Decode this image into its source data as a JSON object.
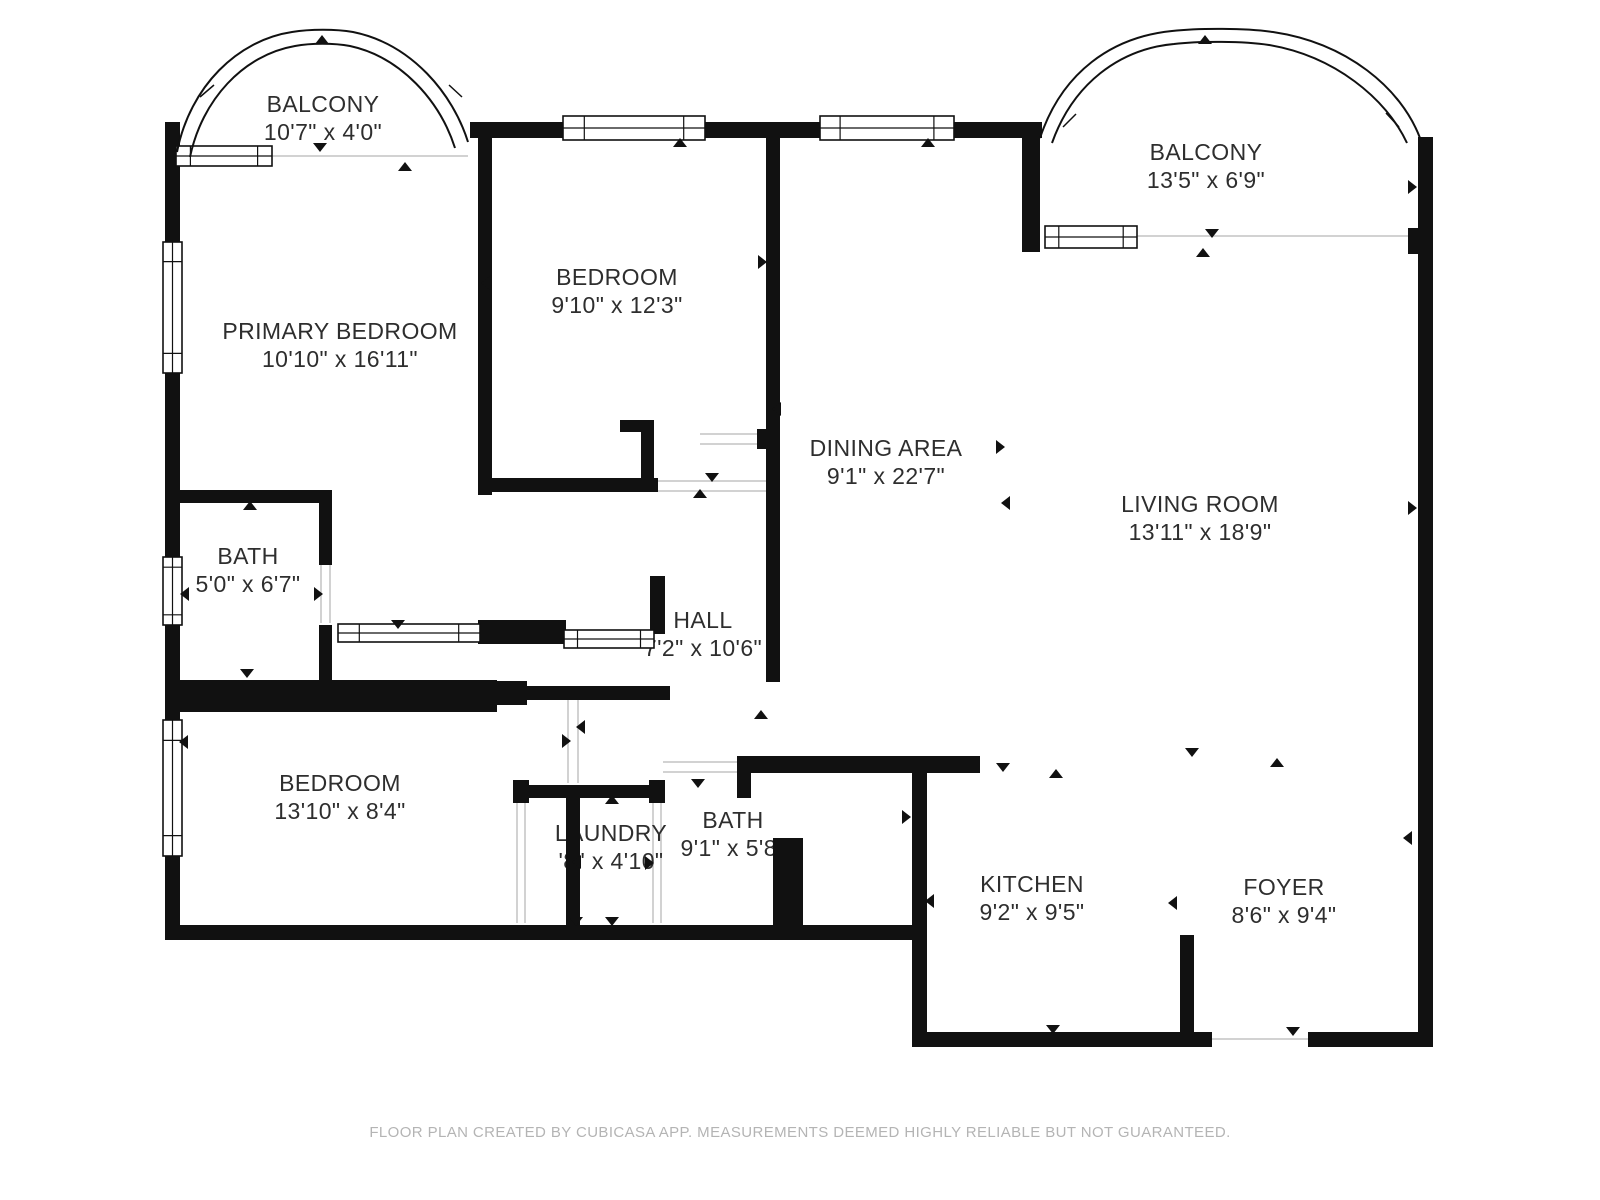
{
  "page": {
    "width": 1600,
    "height": 1200,
    "bg": "#ffffff"
  },
  "footer": {
    "text": "FLOOR PLAN CREATED BY CUBICASA APP. MEASUREMENTS DEEMED HIGHLY RELIABLE BUT NOT GUARANTEED."
  },
  "colors": {
    "wall": "#111111",
    "door_line": "#d2d2d2",
    "text": "#2e2e2e",
    "footer": "#b4b4b4",
    "bg": "#ffffff"
  },
  "rooms": [
    {
      "id": "balcony-top-left",
      "name": "BALCONY",
      "dims": "10'7\" x 4'0\"",
      "x": 323,
      "y": 104
    },
    {
      "id": "balcony-top-right",
      "name": "BALCONY",
      "dims": "13'5\" x 6'9\"",
      "x": 1206,
      "y": 152
    },
    {
      "id": "primary-bedroom",
      "name": "PRIMARY BEDROOM",
      "dims": "10'10\" x 16'11\"",
      "x": 340,
      "y": 331
    },
    {
      "id": "bedroom-top",
      "name": "BEDROOM",
      "dims": "9'10\" x 12'3\"",
      "x": 617,
      "y": 277
    },
    {
      "id": "dining-area",
      "name": "DINING AREA",
      "dims": "9'1\" x 22'7\"",
      "x": 886,
      "y": 448
    },
    {
      "id": "living-room",
      "name": "LIVING ROOM",
      "dims": "13'11\" x 18'9\"",
      "x": 1200,
      "y": 504
    },
    {
      "id": "bath-primary",
      "name": "BATH",
      "dims": "5'0\" x 6'7\"",
      "x": 248,
      "y": 556
    },
    {
      "id": "hall",
      "name": "HALL",
      "dims": "7'2\" x 10'6\"",
      "x": 703,
      "y": 620
    },
    {
      "id": "bedroom-bottom",
      "name": "BEDROOM",
      "dims": "13'10\" x 8'4\"",
      "x": 340,
      "y": 783
    },
    {
      "id": "laundry",
      "name": "LAUNDRY",
      "dims": "'8\" x 4'10\"",
      "x": 611,
      "y": 833
    },
    {
      "id": "bath-main",
      "name": "BATH",
      "dims": "9'1\" x 5'8\"",
      "x": 733,
      "y": 820
    },
    {
      "id": "kitchen",
      "name": "KITCHEN",
      "dims": "9'2\" x 9'5\"",
      "x": 1032,
      "y": 884
    },
    {
      "id": "foyer",
      "name": "FOYER",
      "dims": "8'6\" x 9'4\"",
      "x": 1284,
      "y": 887
    }
  ],
  "plan": {
    "walls": [
      [
        165,
        122,
        15,
        120
      ],
      [
        165,
        373,
        15,
        184
      ],
      [
        165,
        625,
        15,
        95
      ],
      [
        165,
        856,
        15,
        84
      ],
      [
        165,
        925,
        762,
        15
      ],
      [
        912,
        760,
        15,
        287
      ],
      [
        912,
        1032,
        300,
        15
      ],
      [
        1308,
        1032,
        125,
        15
      ],
      [
        1418,
        137,
        15,
        910
      ],
      [
        470,
        122,
        572,
        16
      ],
      [
        1022,
        122,
        18,
        130
      ],
      [
        478,
        138,
        14,
        357
      ],
      [
        766,
        122,
        14,
        560
      ],
      [
        478,
        478,
        180,
        14
      ],
      [
        620,
        420,
        34,
        12
      ],
      [
        641,
        432,
        13,
        50
      ],
      [
        757,
        429,
        9,
        20
      ],
      [
        165,
        490,
        167,
        13
      ],
      [
        319,
        490,
        13,
        75
      ],
      [
        319,
        625,
        13,
        67
      ],
      [
        165,
        680,
        332,
        32
      ],
      [
        497,
        681,
        30,
        24
      ],
      [
        497,
        686,
        173,
        14
      ],
      [
        478,
        620,
        88,
        24
      ],
      [
        650,
        576,
        15,
        58
      ],
      [
        513,
        780,
        16,
        23
      ],
      [
        649,
        780,
        16,
        23
      ],
      [
        513,
        785,
        152,
        13
      ],
      [
        566,
        798,
        14,
        127
      ],
      [
        737,
        756,
        243,
        17
      ],
      [
        737,
        756,
        14,
        42
      ],
      [
        773,
        838,
        30,
        89
      ],
      [
        1180,
        935,
        14,
        99
      ],
      [
        1408,
        228,
        10,
        26
      ]
    ],
    "windows": [
      {
        "x": 163,
        "y": 242,
        "w": 19,
        "h": 131,
        "o": "v"
      },
      {
        "x": 163,
        "y": 557,
        "w": 19,
        "h": 68,
        "o": "v"
      },
      {
        "x": 163,
        "y": 720,
        "w": 19,
        "h": 136,
        "o": "v"
      },
      {
        "x": 176,
        "y": 146,
        "w": 96,
        "h": 20,
        "o": "h"
      },
      {
        "x": 563,
        "y": 116,
        "w": 142,
        "h": 24,
        "o": "h"
      },
      {
        "x": 820,
        "y": 116,
        "w": 134,
        "h": 24,
        "o": "h"
      },
      {
        "x": 1045,
        "y": 226,
        "w": 92,
        "h": 22,
        "o": "h"
      },
      {
        "x": 338,
        "y": 624,
        "w": 142,
        "h": 18,
        "o": "h"
      },
      {
        "x": 564,
        "y": 630,
        "w": 90,
        "h": 18,
        "o": "h"
      }
    ],
    "door_lines": [
      [
        272,
        156,
        468,
        156
      ],
      [
        1137,
        236,
        1416,
        236
      ],
      [
        658,
        481,
        766,
        481
      ],
      [
        658,
        491,
        766,
        491
      ],
      [
        700,
        434,
        757,
        434
      ],
      [
        700,
        444,
        757,
        444
      ],
      [
        321,
        565,
        321,
        623
      ],
      [
        330,
        565,
        330,
        623
      ],
      [
        568,
        700,
        568,
        783
      ],
      [
        578,
        700,
        578,
        783
      ],
      [
        517,
        798,
        517,
        923
      ],
      [
        525,
        798,
        525,
        923
      ],
      [
        653,
        798,
        653,
        923
      ],
      [
        661,
        798,
        661,
        923
      ],
      [
        663,
        762,
        737,
        762
      ],
      [
        663,
        772,
        737,
        772
      ],
      [
        1212,
        1039,
        1308,
        1039
      ]
    ],
    "arches": [
      {
        "id": "balcony-arch-left",
        "outer": "M 177 152 C 190 86 238 40 292 32 C 310 29 336 29 353 32 C 412 44 453 94 468 142",
        "inner": "M 190 157 C 202 100 243 55 295 46 C 311 43 334 43 350 46 C 401 57 440 101 455 148",
        "ticks": [
          [
            200,
            97,
            214,
            85
          ],
          [
            462,
            97,
            449,
            85
          ]
        ]
      },
      {
        "id": "balcony-arch-right",
        "outer": "M 1040 138 C 1062 72 1112 37 1172 31 C 1199 28 1246 28 1273 32 C 1347 43 1401 88 1420 138",
        "inner": "M 1052 143 C 1073 84 1119 49 1174 44 C 1199 41 1244 41 1269 45 C 1334 56 1386 98 1407 143",
        "ticks": [
          [
            1063,
            127,
            1076,
            114
          ],
          [
            1399,
            127,
            1386,
            113
          ]
        ]
      }
    ],
    "arrows": [
      [
        322,
        40,
        "up"
      ],
      [
        320,
        147,
        "down"
      ],
      [
        405,
        167,
        "up"
      ],
      [
        680,
        143,
        "up"
      ],
      [
        928,
        143,
        "up"
      ],
      [
        1205,
        40,
        "up"
      ],
      [
        1212,
        233,
        "down"
      ],
      [
        1203,
        253,
        "up"
      ],
      [
        1412,
        187,
        "right"
      ],
      [
        1412,
        508,
        "right"
      ],
      [
        1408,
        838,
        "left"
      ],
      [
        486,
        283,
        "left"
      ],
      [
        762,
        262,
        "right"
      ],
      [
        777,
        409,
        "left"
      ],
      [
        712,
        477,
        "down"
      ],
      [
        700,
        494,
        "up"
      ],
      [
        250,
        506,
        "up"
      ],
      [
        185,
        594,
        "left"
      ],
      [
        318,
        594,
        "right"
      ],
      [
        247,
        673,
        "down"
      ],
      [
        398,
        624,
        "down"
      ],
      [
        566,
        741,
        "right"
      ],
      [
        581,
        727,
        "left"
      ],
      [
        698,
        783,
        "down"
      ],
      [
        761,
        715,
        "up"
      ],
      [
        577,
        862,
        "left"
      ],
      [
        649,
        863,
        "right"
      ],
      [
        612,
        800,
        "up"
      ],
      [
        612,
        921,
        "down"
      ],
      [
        184,
        742,
        "left"
      ],
      [
        576,
        921,
        "down"
      ],
      [
        906,
        817,
        "right"
      ],
      [
        930,
        901,
        "left"
      ],
      [
        1003,
        767,
        "down"
      ],
      [
        1056,
        774,
        "up"
      ],
      [
        1053,
        1029,
        "down"
      ],
      [
        1173,
        903,
        "left"
      ],
      [
        1293,
        1031,
        "down"
      ],
      [
        1192,
        752,
        "down"
      ],
      [
        1277,
        763,
        "up"
      ],
      [
        1000,
        447,
        "right"
      ],
      [
        1006,
        503,
        "left"
      ]
    ]
  }
}
